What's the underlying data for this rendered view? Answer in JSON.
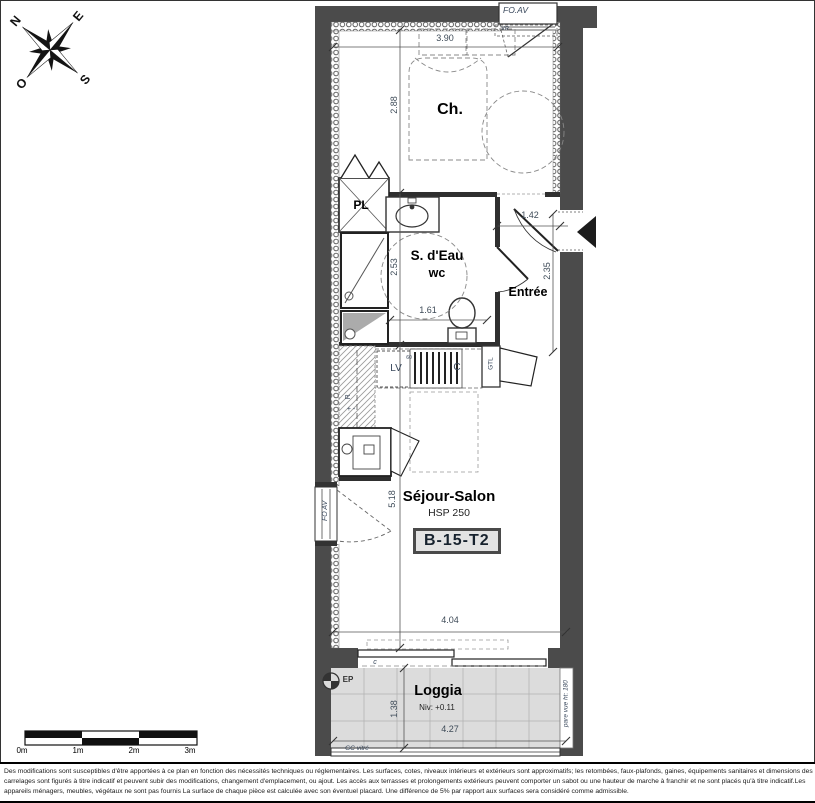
{
  "compass": {
    "n": "N",
    "e": "E",
    "s": "S",
    "o": "O"
  },
  "plan": {
    "badge": "B-15-T2",
    "rooms": {
      "bedroom": "Ch.",
      "bath1": "S. d'Eau",
      "bath2": "wc",
      "entry": "Entrée",
      "living": "Séjour-Salon",
      "living_hsp": "HSP 250",
      "loggia": "Loggia",
      "loggia_level": "Niv: +0.11"
    },
    "labels": {
      "closet": "PL",
      "dishwasher": "LV",
      "dishwasher_size": "60",
      "cooking": "C",
      "gtl": "GTL",
      "fridge": "R",
      "fridge_signs": "+ -",
      "ep": "EP",
      "slider": "c",
      "window_top": "FO.AV",
      "window_top_vr": "VR",
      "window_left": "FO AV",
      "glazing_bottom": "GC vitré",
      "pare_vue": "pare vue ht: 180"
    },
    "dims": {
      "d390": "3.90",
      "d288": "2.88",
      "d253": "2.53",
      "d161": "1.61",
      "d142": "1.42",
      "d235": "2.35",
      "d518": "5.18",
      "d404": "4.04",
      "d138": "1.38",
      "d427": "4.27"
    }
  },
  "scalebar": {
    "l0": "0m",
    "l1": "1m",
    "l2": "2m",
    "l3": "3m"
  },
  "disclaimer": {
    "line1": "Des modifications sont susceptibles d'être apportées à ce plan en fonction des nécessités techniques ou réglementaires. Les surfaces, cotes, niveaux intérieurs et extérieurs sont approximatifs; les retombées, faux-plafonds, gaines, équipements sanitaires et dimensions des",
    "line2": "carrelages sont figurés à titre indicatif et peuvent subir des modifications, changement d'emplacement, ou ajout. Les accès aux terrasses et prolongements extérieurs peuvent comporter un sabot ou une hauteur de marche à franchir et ne sont placés qu'à titre indicatif.Les",
    "line3": "appareils ménagers, meubles, végétaux ne sont pas fournis La surface de chaque pièce est calculée avec son éventuel placard. Une différence de 5% par rapport aux surfaces sera considéré comme admissible."
  }
}
